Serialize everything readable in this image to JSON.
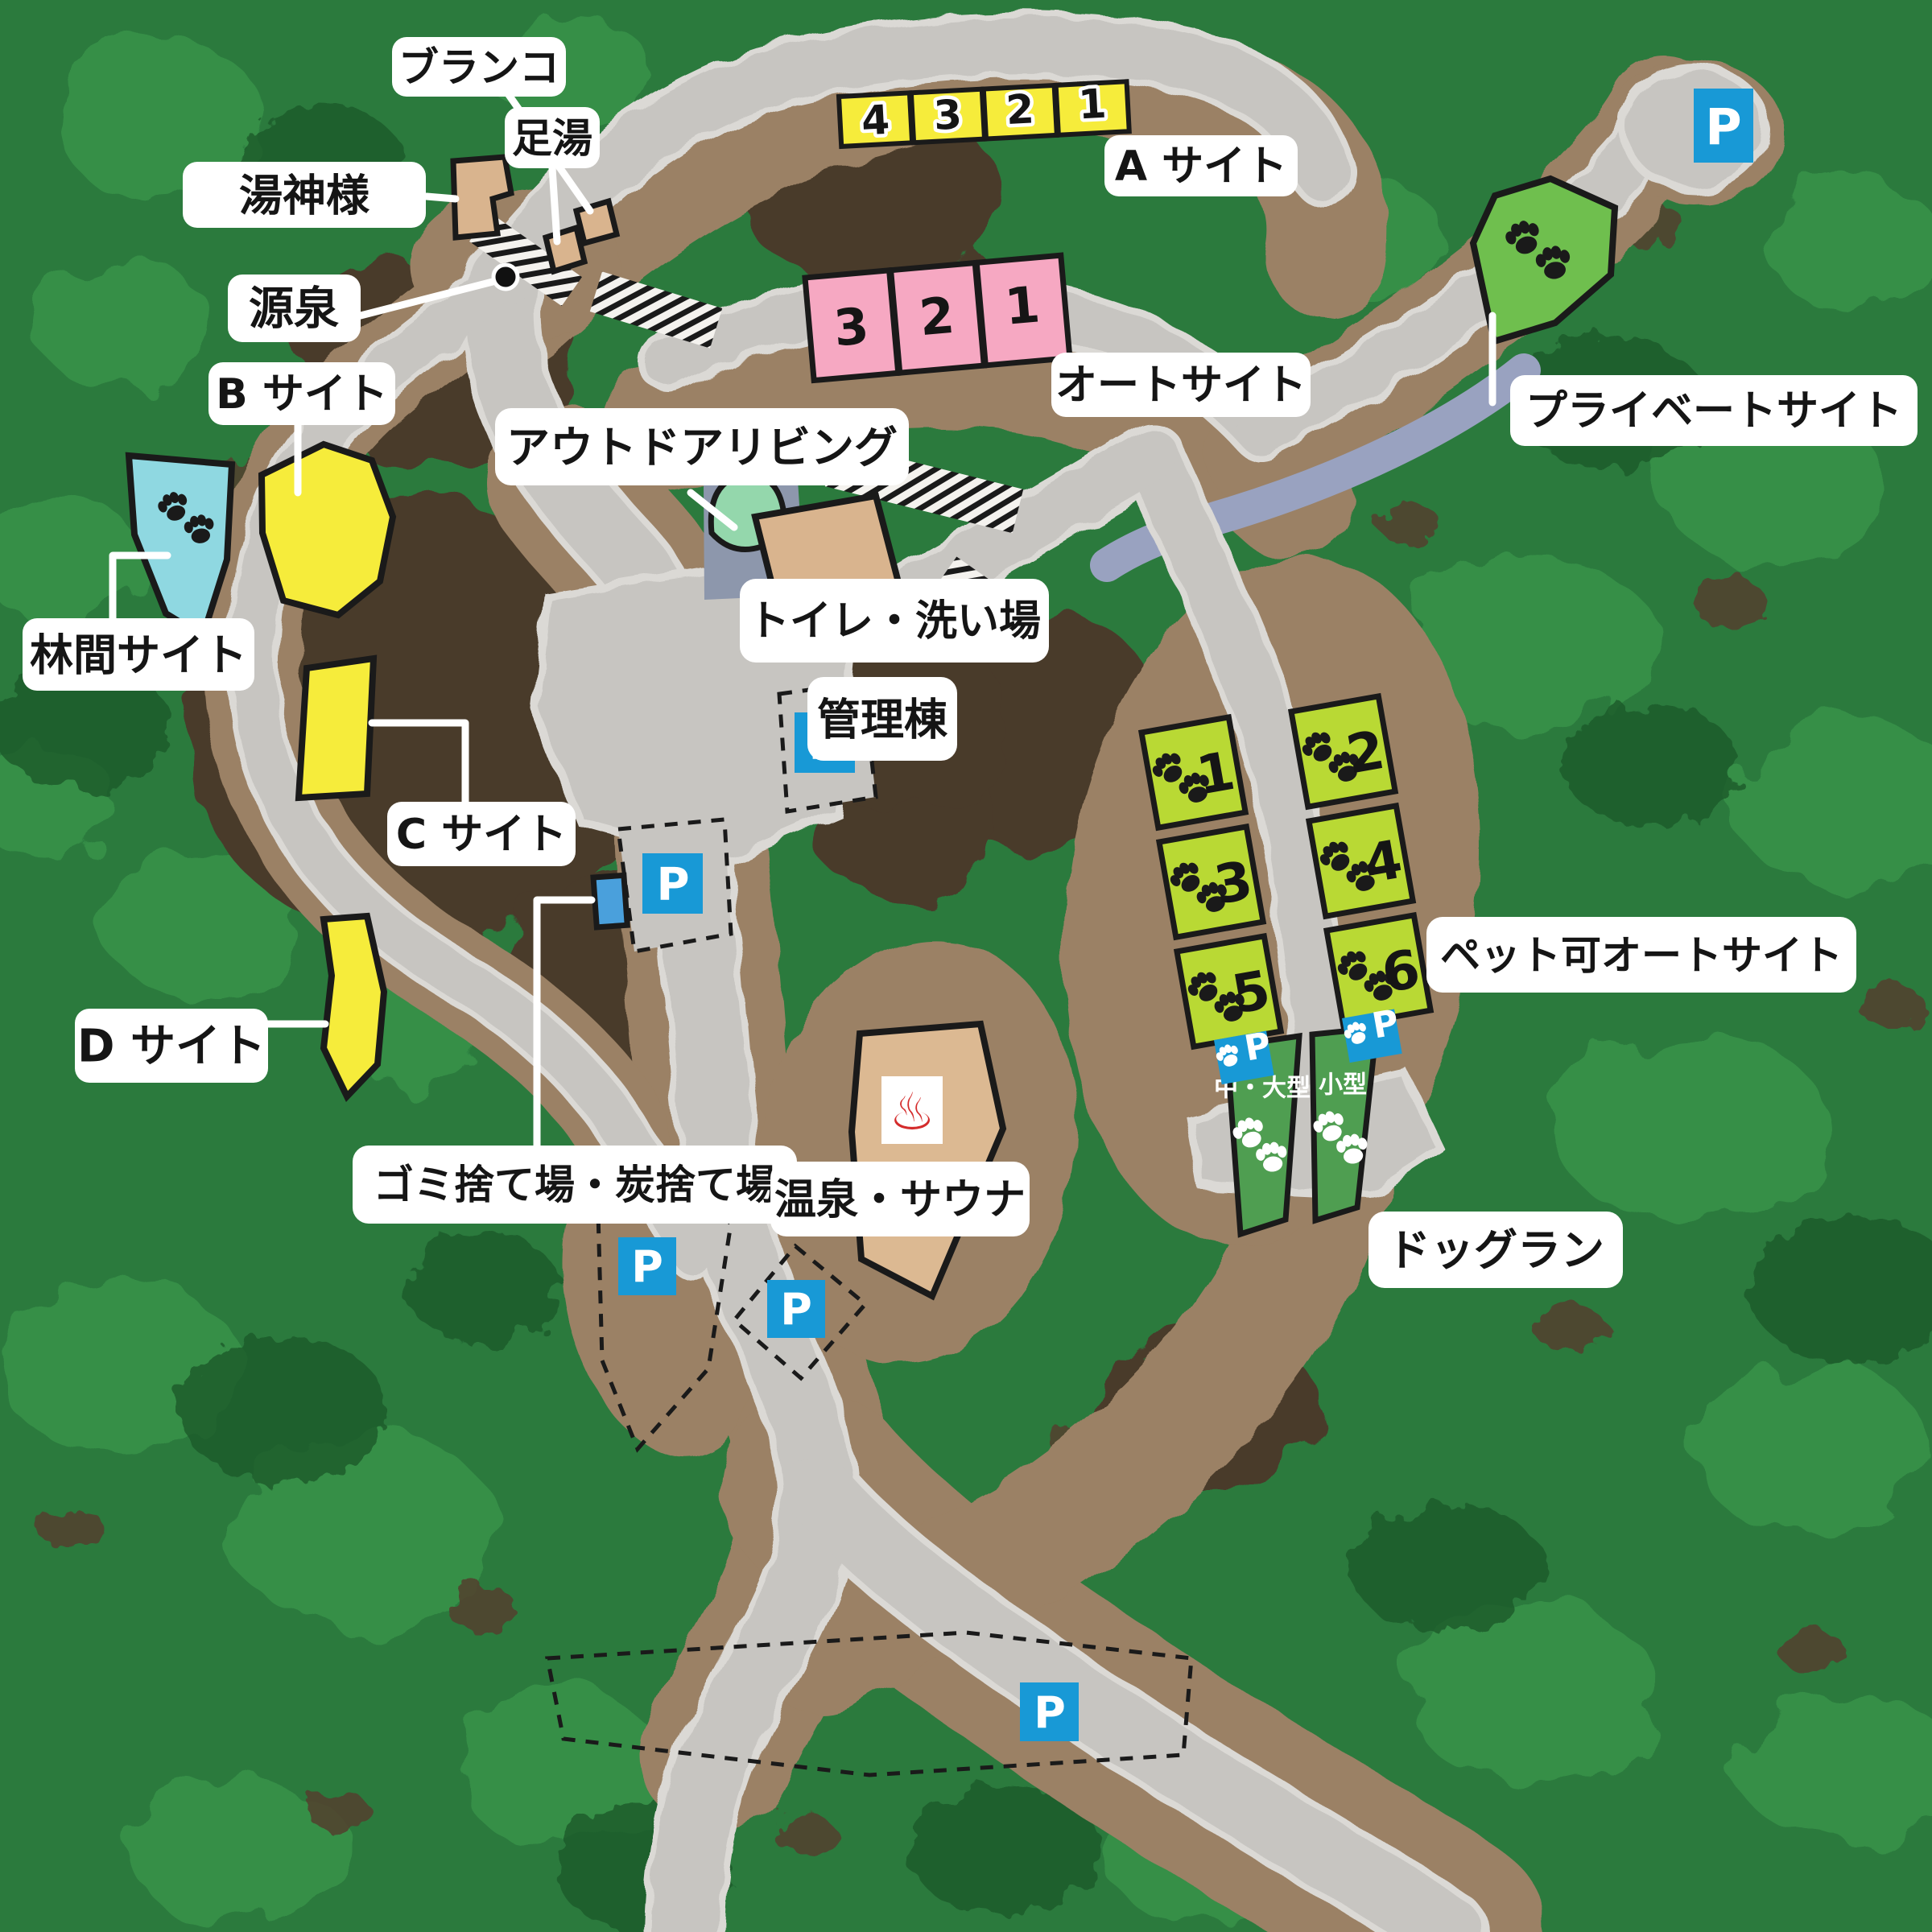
{
  "map": {
    "labels": {
      "buranko": "ブランコ",
      "ashiyu": "足湯",
      "yugamisama": "湯神様",
      "gensen": "源泉",
      "a_site": "A サイト",
      "auto_site": "オートサイト",
      "private_site": "プライベートサイト",
      "b_site": "B サイト",
      "rinkan_site": "林間サイト",
      "outdoor_living": "アウトドアリビング",
      "toilet_washing": "トイレ・洗い場",
      "kanritou": "管理棟",
      "c_site": "C サイト",
      "d_site": "D サイト",
      "gomi_sumi": "ゴミ捨て場・炭捨て場",
      "onsen_sauna": "温泉・サウナ",
      "pet_auto_site": "ペット可オートサイト",
      "dog_run": "ドッグラン"
    },
    "dog_run_areas": [
      "中・大型",
      "小型"
    ],
    "a_site_cells": [
      "4",
      "3",
      "2",
      "1"
    ],
    "auto_site_cells": [
      "3",
      "2",
      "1"
    ],
    "pet_site_cells_left": [
      "1",
      "3",
      "5"
    ],
    "pet_site_cells_right": [
      "2",
      "4",
      "6"
    ],
    "parking_letter": "P",
    "onsen_icon_glyph": "♨",
    "colors": {
      "forest_base": "#2b7a3d",
      "forest_light": "#37924a",
      "forest_dark": "#1d5a2c",
      "soil_dark": "#4a3a2b",
      "soil_light": "#9b8165",
      "road_gray": "#c7c5c1",
      "road_edge": "#dbd9d5",
      "stream_gray_blue": "#99a2c0",
      "site_yellow": "#f6ec3b",
      "site_pink": "#f6a8c2",
      "site_cyan": "#8fd8e1",
      "site_lime": "#b9d934",
      "site_green": "#6fbf4e",
      "dog_run_green": "#4f9e51",
      "mint_green": "#94d7ac",
      "blue_gray": "#8d97ac",
      "building_tan": "#d9b48e",
      "parking_blue": "#1899d6",
      "garbage_blue": "#4aa0dc",
      "onsen_red": "#d42b2b",
      "label_bg": "#ffffff",
      "label_text": "#151515"
    }
  }
}
